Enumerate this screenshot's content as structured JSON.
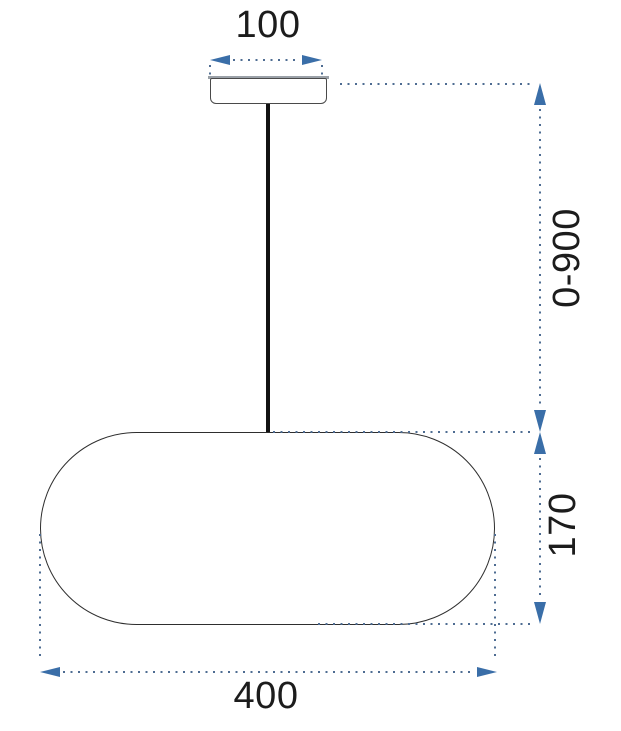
{
  "diagram": {
    "dimensions": [
      {
        "id": "canopy-width",
        "label": "100",
        "orientation": "horizontal"
      },
      {
        "id": "suspension-drop",
        "label": "0-900",
        "orientation": "vertical"
      },
      {
        "id": "shade-height",
        "label": "170",
        "orientation": "vertical"
      },
      {
        "id": "shade-width",
        "label": "400",
        "orientation": "horizontal"
      }
    ],
    "parts": [
      {
        "id": "ceiling-canopy"
      },
      {
        "id": "suspension-cable"
      },
      {
        "id": "lampshade"
      }
    ]
  },
  "colors": {
    "canvas_bg": "#ffffff",
    "text": "#1c1c1c",
    "accent": "#3a6ea8",
    "dot": "#4e6c92",
    "ink": "#2e2e2e",
    "cable": "#121212",
    "canopy_border": "#4a4a4a",
    "canopy_top": "#9ba1a8"
  }
}
